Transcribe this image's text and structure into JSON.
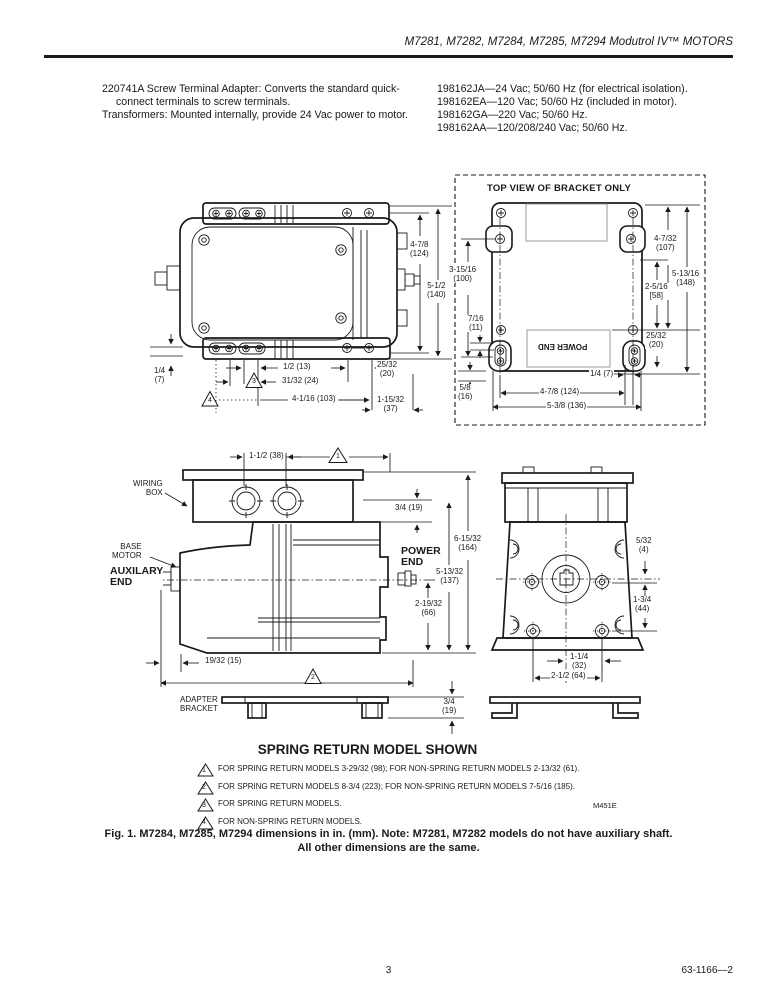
{
  "header": {
    "title": "M7281, M7282, M7284, M7285, M7294 Modutrol IV™ MOTORS"
  },
  "intro": {
    "left": [
      "220741A Screw Terminal Adapter: Converts the standard quick-connect terminals to screw terminals.",
      "Transformers: Mounted internally, provide 24 Vac power to motor."
    ],
    "right": [
      "198162JA—24 Vac; 50/60 Hz (for electrical isolation).",
      "198162EA—120 Vac; 50/60 Hz (included in motor).",
      "198162GA—220 Vac; 50/60 Hz.",
      "198162AA—120/208/240 Vac; 50/60 Hz."
    ]
  },
  "figure": {
    "motor_top": {
      "dims": {
        "h1": "4-7/8\n(124)",
        "h2": "5-1/2\n(140)",
        "q": "1/4\n(7)",
        "half": "1/2 (13)",
        "s2532": "25/32\n(20)",
        "s3132": "31/32 (24)",
        "s4116": "4-1/16 (103)",
        "s11532": "1-15/32\n(37)"
      }
    },
    "bracket": {
      "title": "TOP VIEW OF BRACKET ONLY",
      "power_end": "POWER END",
      "dims": {
        "v100": "3-15/16\n(100)",
        "v11": "7/16\n(11)",
        "v16": "5/8\n(16)",
        "v107": "4-7/32\n(107)",
        "v148": "5-13/16\n(148)",
        "v58": "2-5/16\n[58]",
        "v20": "25/32\n(20)",
        "q7": "1/4 (7)",
        "w124": "4-7/8 (124)",
        "w136": "5-3/8 (136)"
      }
    },
    "side": {
      "labels": {
        "wiring": "WIRING\nBOX",
        "base": "BASE\nMOTOR",
        "aux": "AUXILARY\nEND",
        "power": "POWER\nEND",
        "adapter": "ADAPTER\nBRACKET"
      },
      "dims": {
        "d38": "1-1/2 (38)",
        "d19a": "3/4 (19)",
        "d164": "6-15/32\n(164)",
        "d137": "5-13/32\n(137)",
        "d66": "2-19/32\n(66)",
        "d15": "19/32 (15)",
        "d19b": "3/4\n(19)"
      }
    },
    "end_view": {
      "dims": {
        "d4": "5/32\n(4)",
        "d44": "1-3/4\n(44)",
        "d32": "1-1/4\n(32)",
        "d64": "2-1/2 (64)"
      }
    },
    "markers": {
      "m1": "1",
      "m2": "2",
      "m3": "3",
      "m4": "4"
    }
  },
  "notes": {
    "heading": "SPRING RETURN MODEL SHOWN",
    "items": [
      {
        "num": "1",
        "text": "FOR SPRING RETURN MODELS 3-29/32 (98); FOR NON-SPRING RETURN MODELS 2-13/32 (61)."
      },
      {
        "num": "2",
        "text": "FOR SPRING RETURN MODELS 8-3/4 (223); FOR NON-SPRING RETURN MODELS 7-5/16 (185)."
      },
      {
        "num": "3",
        "text": "FOR SPRING RETURN MODELS."
      },
      {
        "num": "4",
        "text": "FOR NON-SPRING RETURN MODELS."
      }
    ],
    "drawing_code": "M451E"
  },
  "caption": {
    "line1": "Fig. 1. M7284, M7285, M7294 dimensions in in. (mm). Note: M7281, M7282 models do not have auxiliary shaft.",
    "line2": "All other dimensions are the same."
  },
  "footer": {
    "page": "3",
    "doc_number": "63-1166—2"
  }
}
